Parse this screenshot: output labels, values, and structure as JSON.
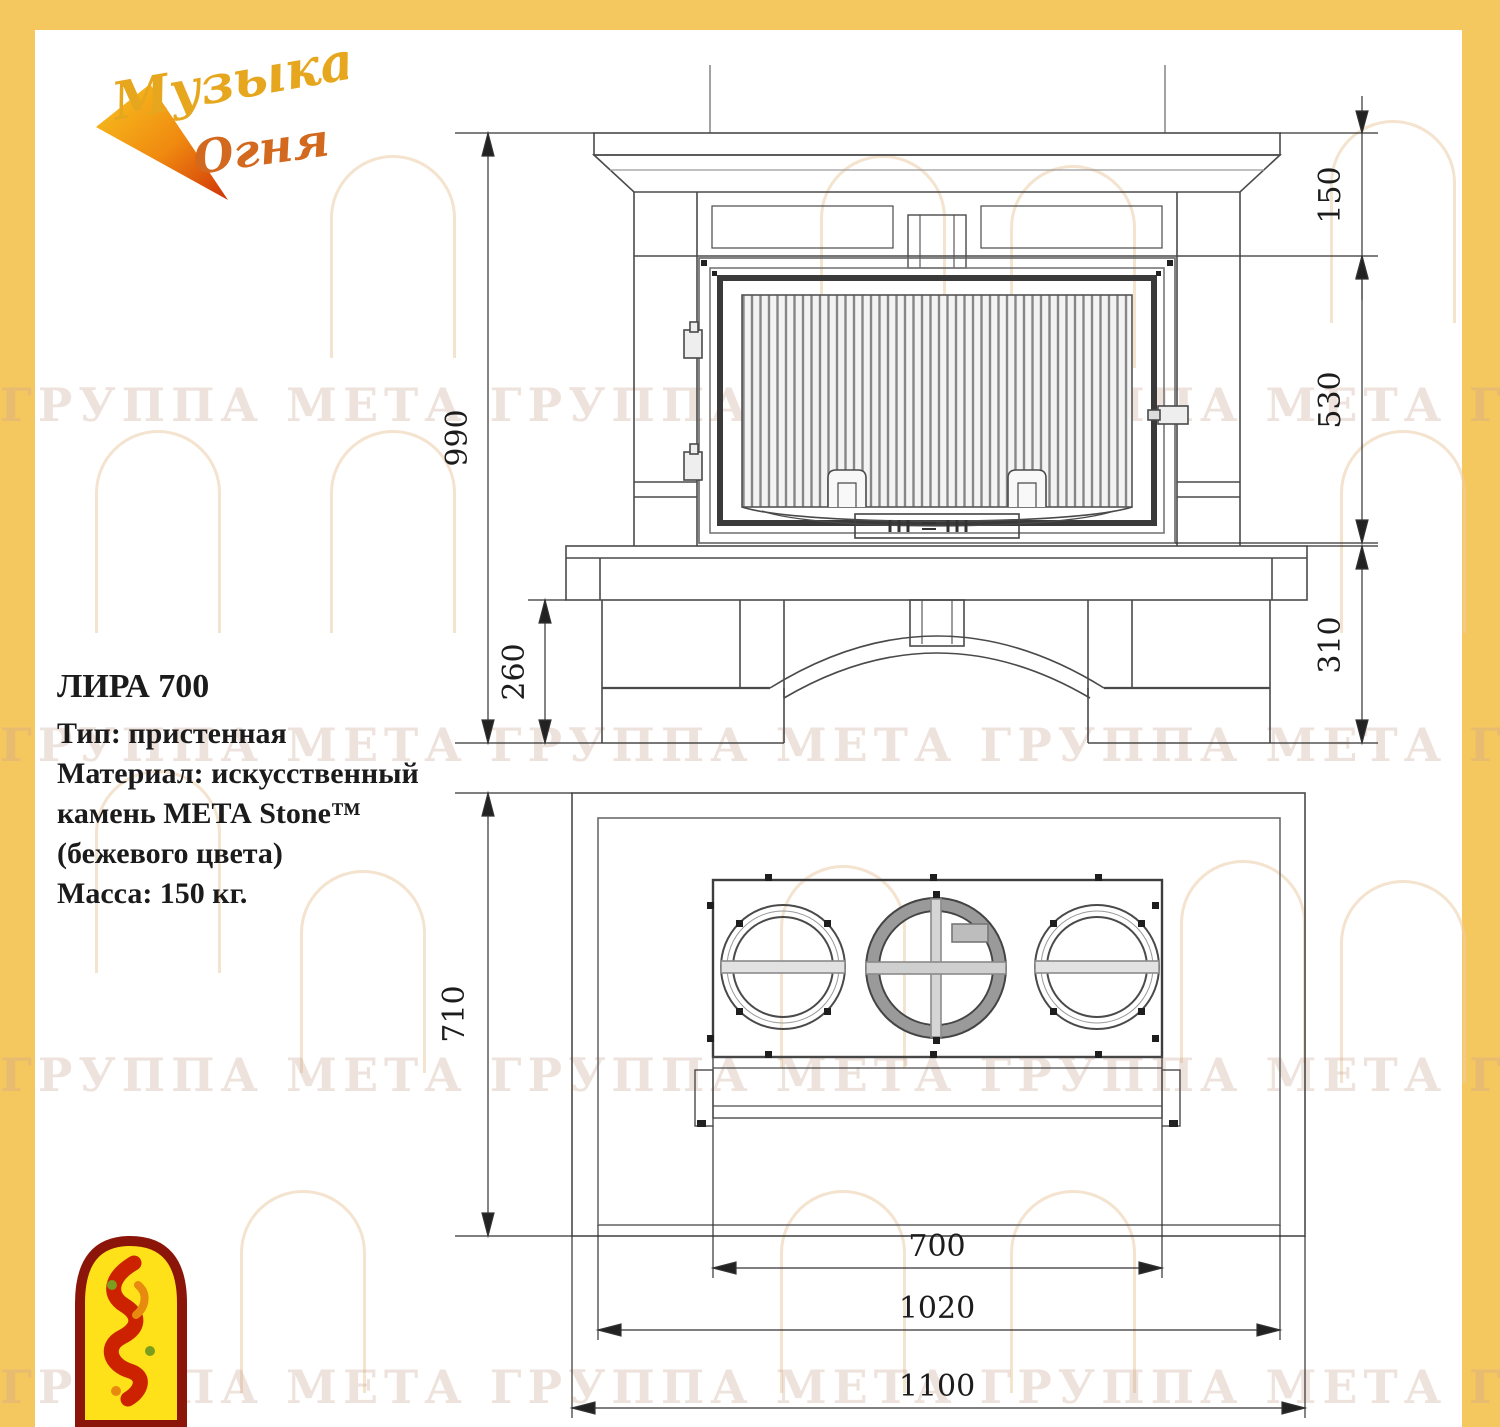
{
  "brand": {
    "logo_word1": "Музыка",
    "logo_word2": "Огня"
  },
  "product": {
    "title": "ЛИРА 700",
    "type_line": "Тип: пристенная",
    "material_line1": "Материал: искусственный",
    "material_line2": "камень МЕТА Stone™",
    "material_line3": "(бежевого  цвета)",
    "mass_line": "Масса: 150 кг."
  },
  "front_view": {
    "dims": {
      "total_height": "990",
      "mantel_height": "150",
      "firebox_height": "530",
      "base_height": "260",
      "plinth_height": "310"
    }
  },
  "plan_view": {
    "dims": {
      "depth": "710",
      "insert_width": "700",
      "shelf_width": "1020",
      "total_width": "1100"
    }
  },
  "watermark": {
    "row_text": "ГРУППА МЕТА ГРУППА МЕТА ГРУППА МЕТА ГРУППА МЕТА"
  },
  "colors": {
    "frame_yellow": "#F5C75F",
    "line_dark": "#3a3a3a",
    "logo_red": "#C42508",
    "logo_yellow": "#FFE11A"
  }
}
